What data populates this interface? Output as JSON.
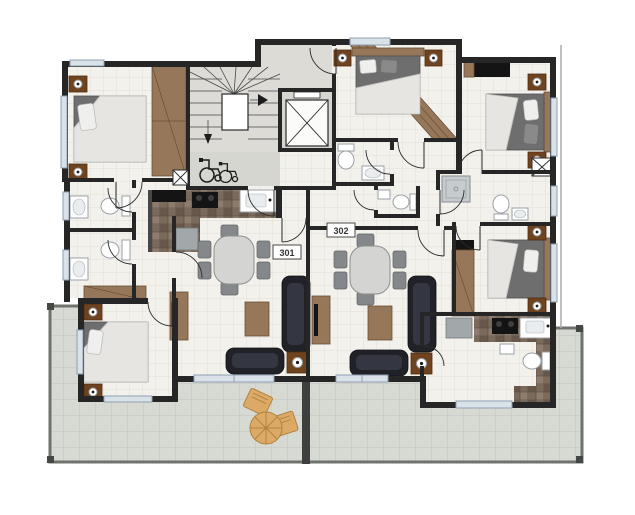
{
  "units": [
    {
      "label": "301"
    },
    {
      "label": "302"
    }
  ],
  "icons": {
    "stairs": "stairs-icon",
    "elevator": "elevator-icon",
    "wheelchair": "wheelchair-icon",
    "duct": "x-duct-icon"
  },
  "colors": {
    "wall": "#262626",
    "window": "#d9e1e9",
    "window_frame": "#8ea0b2",
    "wood": "#96775a",
    "wood_dark": "#70431f",
    "sofa": "#202227",
    "table": "#d4d5d3",
    "chair": "#85888a",
    "terrace_wood": "#dcaa66",
    "label_text": "#333333",
    "floor": "#f3f1ec",
    "terrace": "#d7d9d3",
    "marble": "#7a6a5c"
  }
}
